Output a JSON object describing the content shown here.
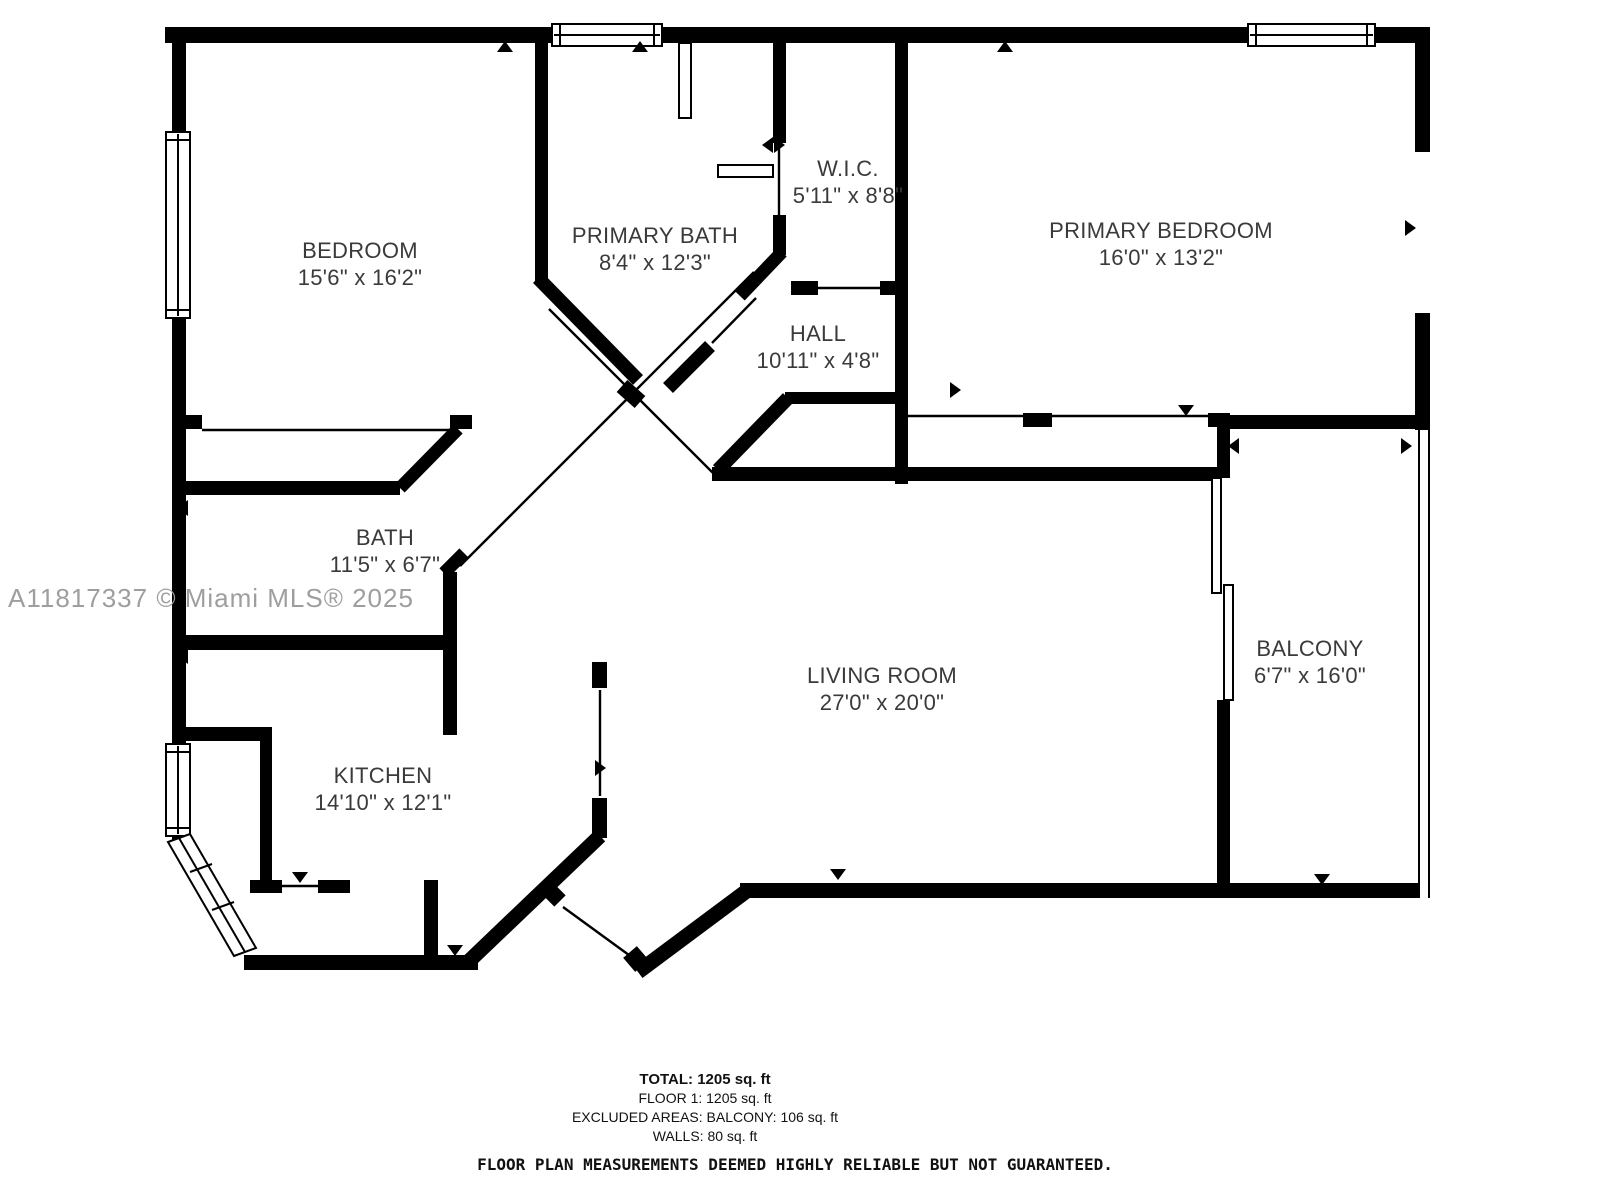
{
  "watermark": "A11817337 © Miami MLS® 2025",
  "rooms": [
    {
      "id": "bedroom",
      "name": "BEDROOM",
      "dims": "15'6\" x 16'2\""
    },
    {
      "id": "primary-bath",
      "name": "PRIMARY BATH",
      "dims": "8'4\" x 12'3\""
    },
    {
      "id": "wic",
      "name": "W.I.C.",
      "dims": "5'11\" x 8'8\""
    },
    {
      "id": "primary-bedroom",
      "name": "PRIMARY BEDROOM",
      "dims": "16'0\" x 13'2\""
    },
    {
      "id": "hall",
      "name": "HALL",
      "dims": "10'11\" x 4'8\""
    },
    {
      "id": "bath",
      "name": "BATH",
      "dims": "11'5\" x 6'7\""
    },
    {
      "id": "living-room",
      "name": "LIVING ROOM",
      "dims": "27'0\" x 20'0\""
    },
    {
      "id": "kitchen",
      "name": "KITCHEN",
      "dims": "14'10\" x 12'1\""
    },
    {
      "id": "balcony",
      "name": "BALCONY",
      "dims": "6'7\" x 16'0\""
    }
  ],
  "summary": {
    "total": "TOTAL: 1205 sq. ft",
    "floor1": "FLOOR 1: 1205 sq. ft",
    "excluded": "EXCLUDED AREAS: BALCONY: 106 sq. ft",
    "walls": "WALLS: 80 sq. ft",
    "disclaimer": "FLOOR PLAN MEASUREMENTS DEEMED HIGHLY RELIABLE BUT NOT GUARANTEED."
  },
  "colors": {
    "wall": "#000000",
    "background": "#ffffff",
    "watermark": "#9e9e9e",
    "label": "#3a3a3a"
  }
}
